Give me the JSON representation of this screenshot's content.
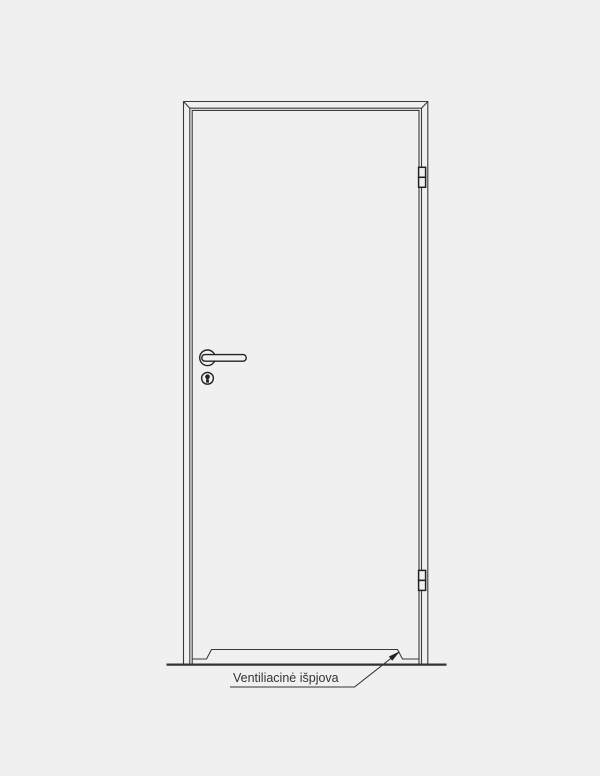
{
  "label": {
    "ventilation_cutout": "Ventiliacinė išpjova"
  },
  "colors": {
    "background": "#f0f0f0",
    "line": "#3a3a3a",
    "hardware": "#222222",
    "text": "#333333"
  },
  "components": [
    "door-frame",
    "door-leaf",
    "hinge-top",
    "hinge-bottom",
    "lever-handle",
    "keyhole",
    "ventilation-cutout",
    "ground-line",
    "leader-arrow",
    "ventilation-label"
  ]
}
